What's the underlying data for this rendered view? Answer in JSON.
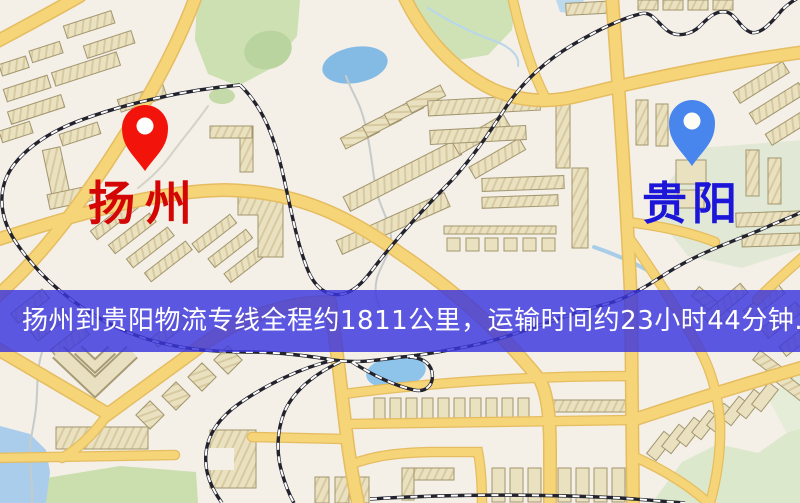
{
  "banner": {
    "text": "扬州到贵阳物流专线全程约1811公里，运输时间约23小时44分钟.",
    "bg_color": "rgba(58,54,222,0.82)",
    "text_color": "#ffffff"
  },
  "markers": {
    "origin": {
      "label": "扬州",
      "pin_color": "#f2130b",
      "label_color": "#d40505"
    },
    "destination": {
      "label": "贵阳",
      "pin_color": "#4886ee",
      "label_color": "#1b16d8"
    }
  },
  "palette": {
    "map_background": "#f4efe7",
    "road": "#f6d478",
    "road_casing": "#e5bd60",
    "railway": "#23232e",
    "park_green": "#cfe2b6",
    "water_blue": "#8ec4ea",
    "building_beige": "#eae1c1"
  }
}
